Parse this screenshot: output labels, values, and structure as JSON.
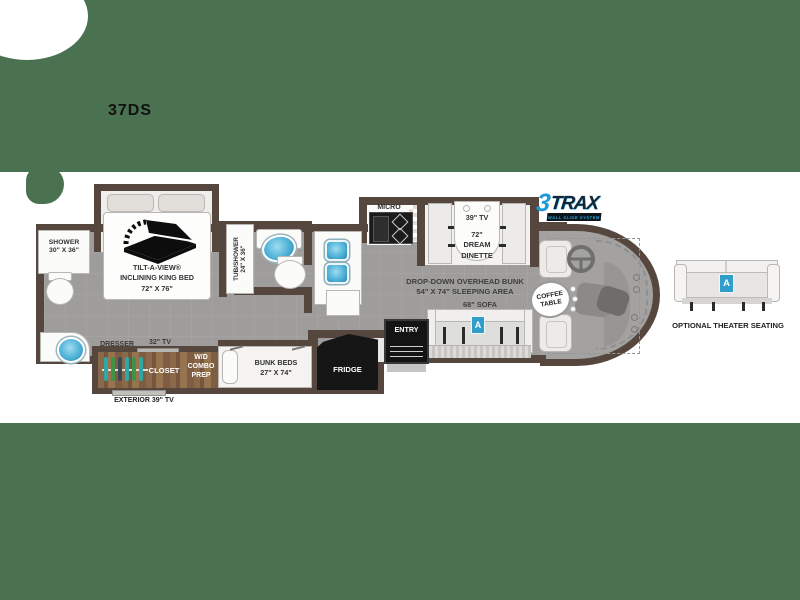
{
  "model": "37DS",
  "logo": {
    "three": "3",
    "trax": "TRAX",
    "tagline": "WALL SLIDE SYSTEM"
  },
  "labels": {
    "shower1": "SHOWER",
    "shower2": "30\" X 36\"",
    "bed1": "TILT-A-VIEW®",
    "bed2": "INCLINING KING BED",
    "bed3": "72\" X 76\"",
    "tub1": "TUB/SHOWER",
    "tub2": "24\" X 36\"",
    "dresser": "DRESSER",
    "tv32": "32\" TV",
    "closet": "CLOSET",
    "wd1": "W/D",
    "wd2": "COMBO",
    "wd3": "PREP",
    "bunk1": "BUNK BEDS",
    "bunk2": "27\" X 74\"",
    "exterior_tv": "EXTERIOR 39\" TV",
    "fridge": "FRIDGE",
    "entry": "ENTRY",
    "micro": "MICRO",
    "tv39": "39\" TV",
    "dinette1": "72\"",
    "dinette2": "DREAM",
    "dinette3": "DINETTE",
    "ohbunk1": "DROP-DOWN OVERHEAD BUNK",
    "ohbunk2": "54\" X 74\" SLEEPING AREA",
    "sofa": "68\" SOFA",
    "coffee1": "COFFEE",
    "coffee2": "TABLE",
    "theater": "OPTIONAL THEATER SEATING",
    "badge": "A"
  },
  "colors": {
    "background": "#4a7150",
    "wall": "#56473e",
    "floor": "#9e9d9b",
    "wood": "#8a684a",
    "accent_blue": "#2f9fc9",
    "logo_blue": "#1b9ad6"
  }
}
